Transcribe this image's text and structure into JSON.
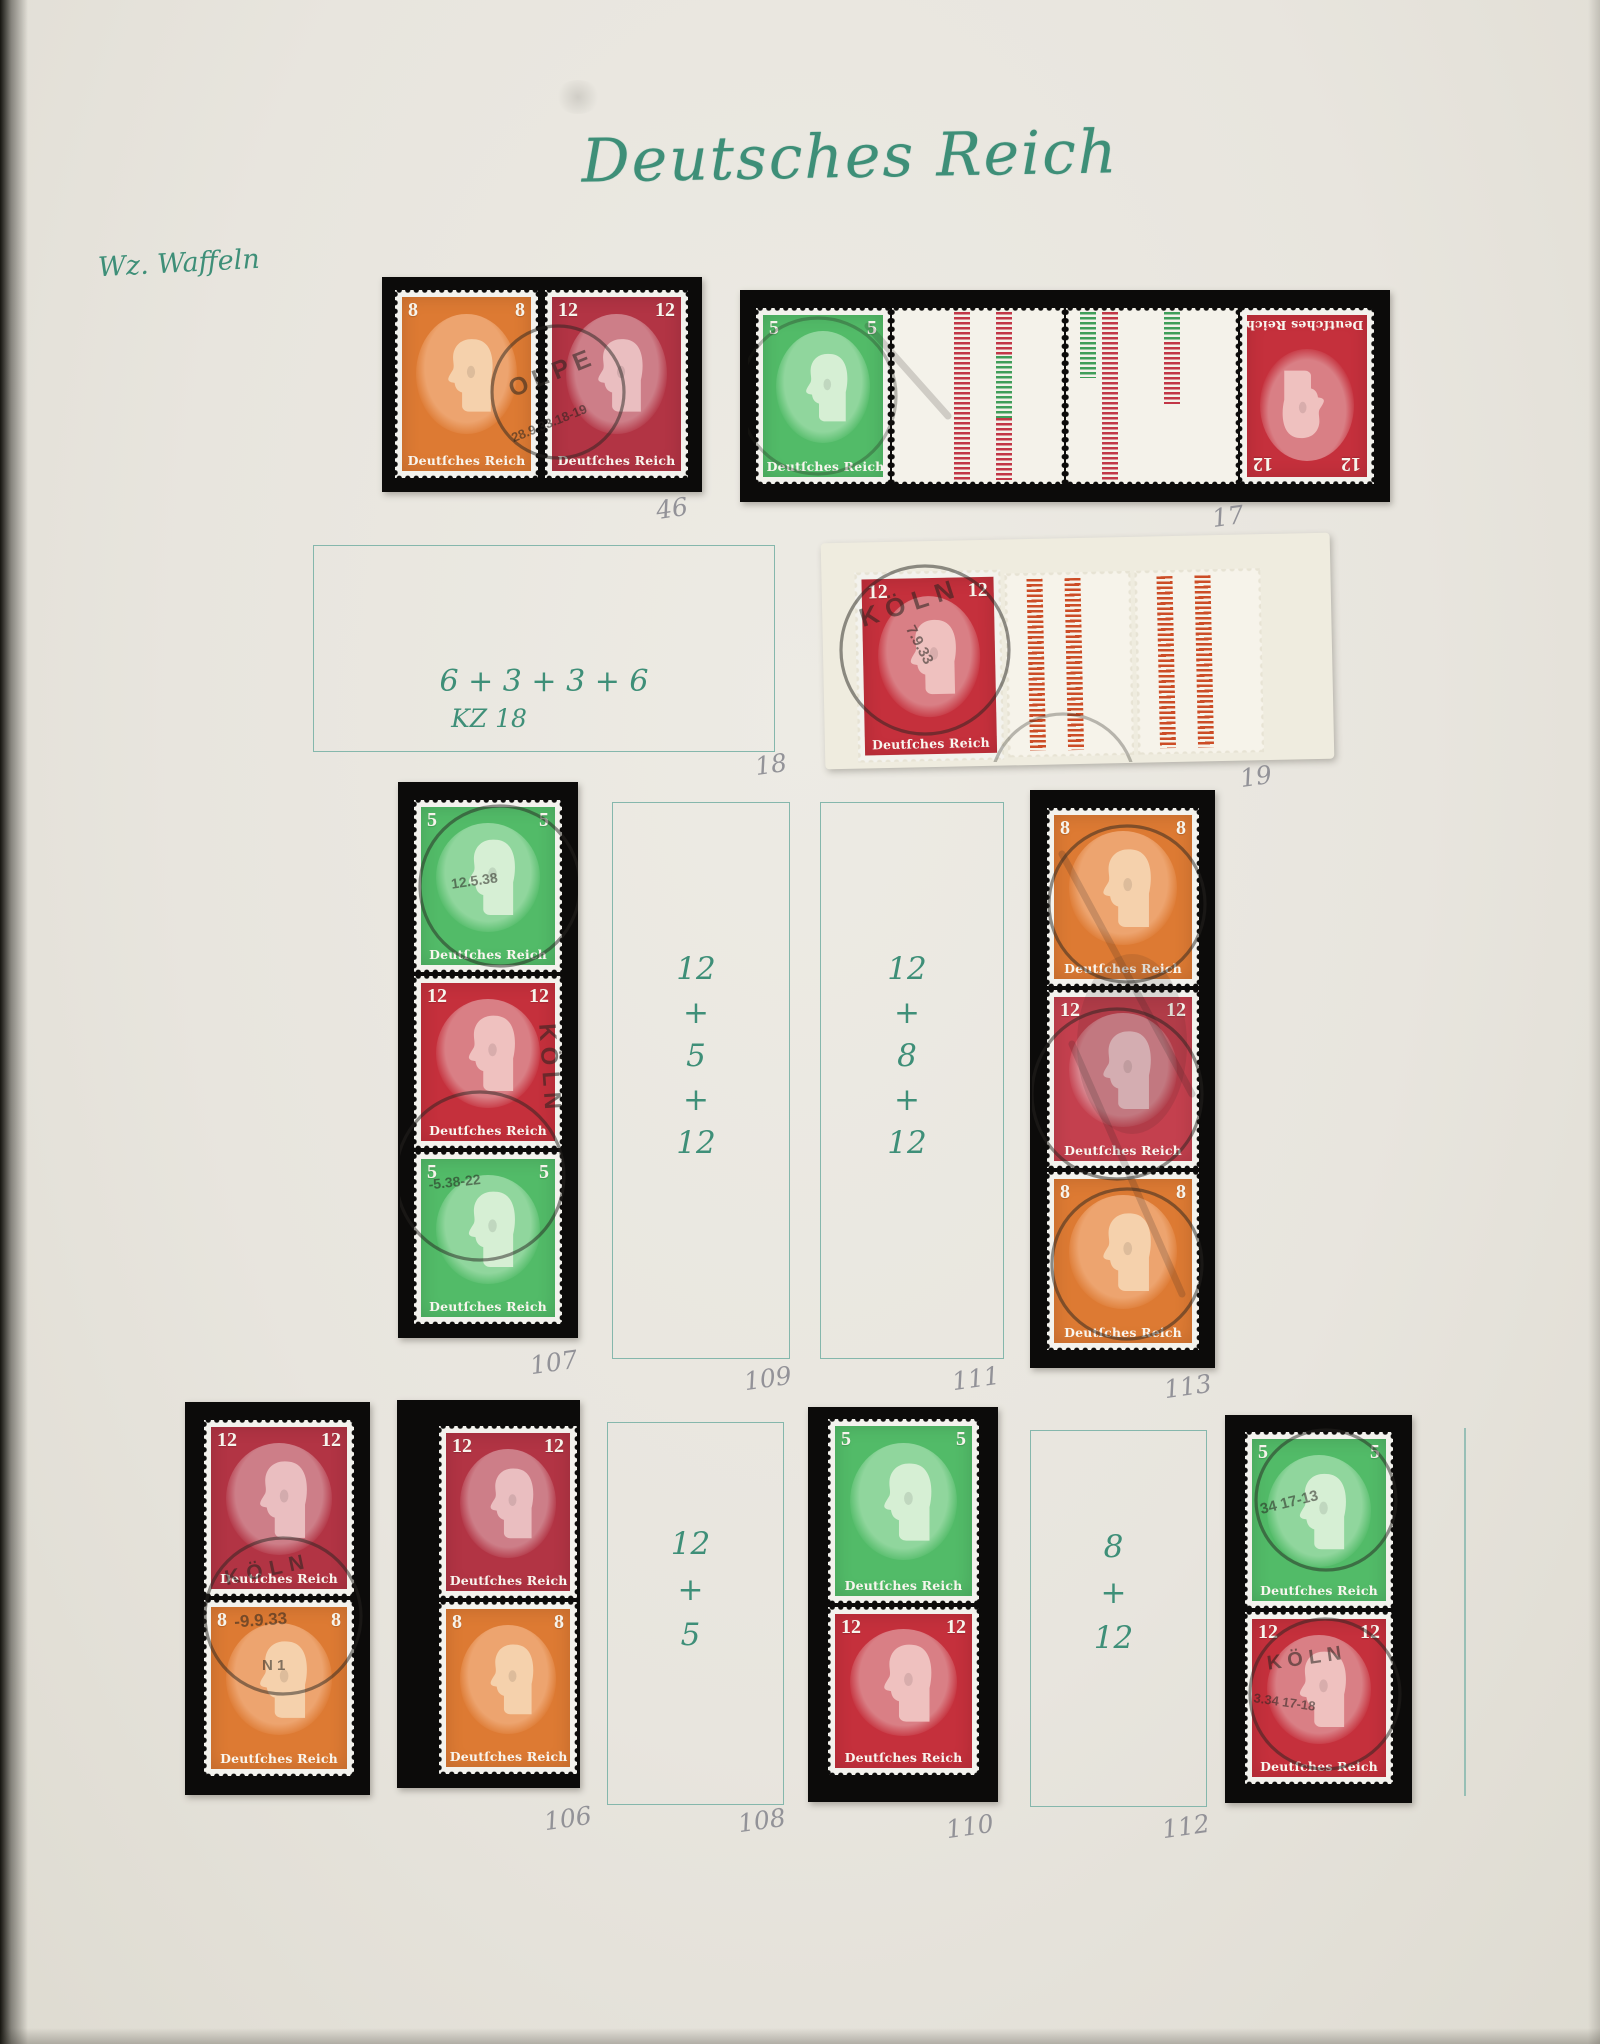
{
  "page": {
    "title": "Deutsches Reich",
    "watermark_note": "Wz. Waffeln"
  },
  "stamp": {
    "inscription": "Deutſches Reich",
    "den5": "5",
    "den8": "8",
    "den12": "12"
  },
  "handwriting": {
    "kz_line": "6 + 3 + 3 + 6",
    "kz_catalog": "KZ 18",
    "v5": "5",
    "v8": "8",
    "v12": "12",
    "plus": "+"
  },
  "pencil": {
    "n46": "46",
    "n17": "17",
    "n18": "18",
    "n19": "19",
    "n106": "106",
    "n107": "107",
    "n108": "108",
    "n109": "109",
    "n110": "110",
    "n111": "111",
    "n112": "112",
    "n113": "113"
  },
  "postmarks": {
    "olpe": "OLPE",
    "koln": "KÖLN",
    "date46": "28.9.33.18-19",
    "date19": "7.9.33",
    "date107a": "12.5.38",
    "date107b": "-5.38-22",
    "date105": "-9.9.33",
    "mark105": "N 1",
    "date114a": "34 17-13",
    "date114b": "3.34 17-18"
  }
}
